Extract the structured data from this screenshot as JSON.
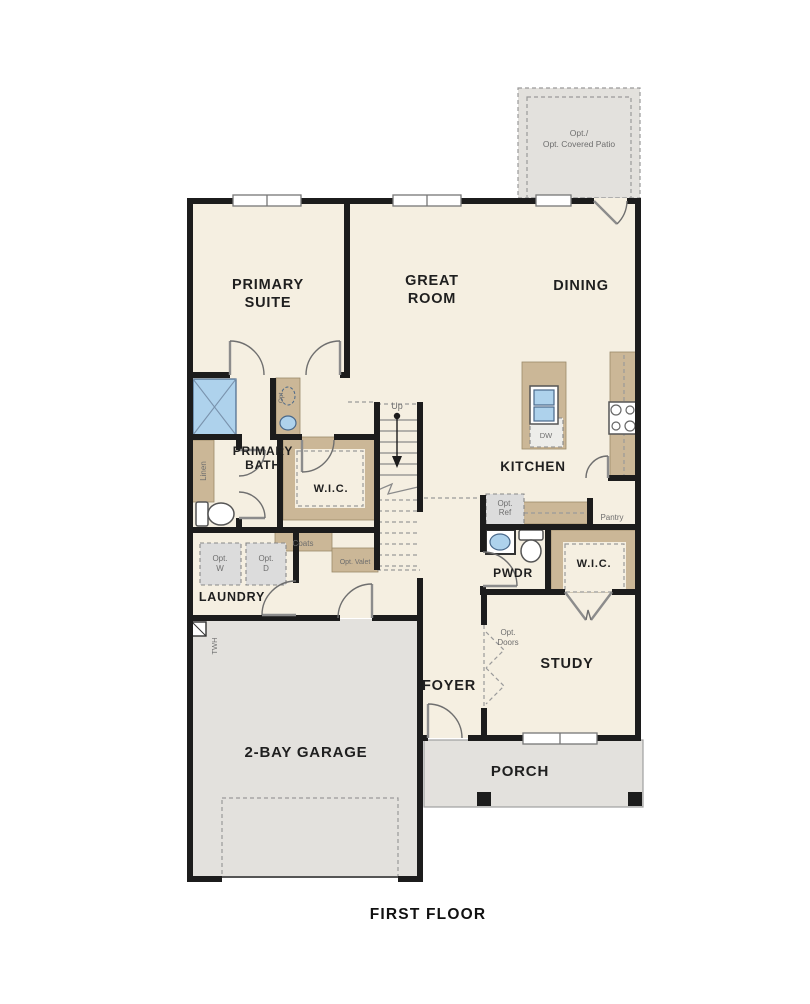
{
  "title": "FIRST FLOOR",
  "colors": {
    "wall": "#1c1c1c",
    "floor_cream": "#f5efe1",
    "concrete_gray": "#e3e1dd",
    "cabinet_tan": "#cbb797",
    "fixture_blue": "#aed2ec"
  },
  "rooms": {
    "patio": {
      "line1": "Opt./",
      "line2": "Opt. Covered Patio"
    },
    "primary_suite": {
      "line1": "PRIMARY",
      "line2": "SUITE"
    },
    "great_room": {
      "line1": "GREAT",
      "line2": "ROOM"
    },
    "dining": {
      "label": "DINING"
    },
    "primary_bath": {
      "line1": "PRIMARY",
      "line2": "BATH"
    },
    "wic_primary": {
      "label": "W.I.C."
    },
    "kitchen": {
      "label": "KITCHEN"
    },
    "laundry": {
      "label": "LAUNDRY"
    },
    "pwdr": {
      "label": "PWDR"
    },
    "wic_study": {
      "label": "W.I.C."
    },
    "study": {
      "label": "STUDY"
    },
    "foyer": {
      "label": "FOYER"
    },
    "garage": {
      "label": "2-BAY GARAGE"
    },
    "porch": {
      "label": "PORCH"
    }
  },
  "annotations": {
    "up": "Up",
    "dw": "DW",
    "opt_ref": {
      "line1": "Opt.",
      "line2": "Ref"
    },
    "pantry": "Pantry",
    "coats": "Coats",
    "opt_w": {
      "line1": "Opt.",
      "line2": "W"
    },
    "opt_d": {
      "line1": "Opt.",
      "line2": "D"
    },
    "opt_valet": "Opt. Valet",
    "linen": "Linen",
    "opt_sink": "Opt.",
    "twh": "TWH",
    "opt_doors": {
      "line1": "Opt.",
      "line2": "Doors"
    }
  }
}
